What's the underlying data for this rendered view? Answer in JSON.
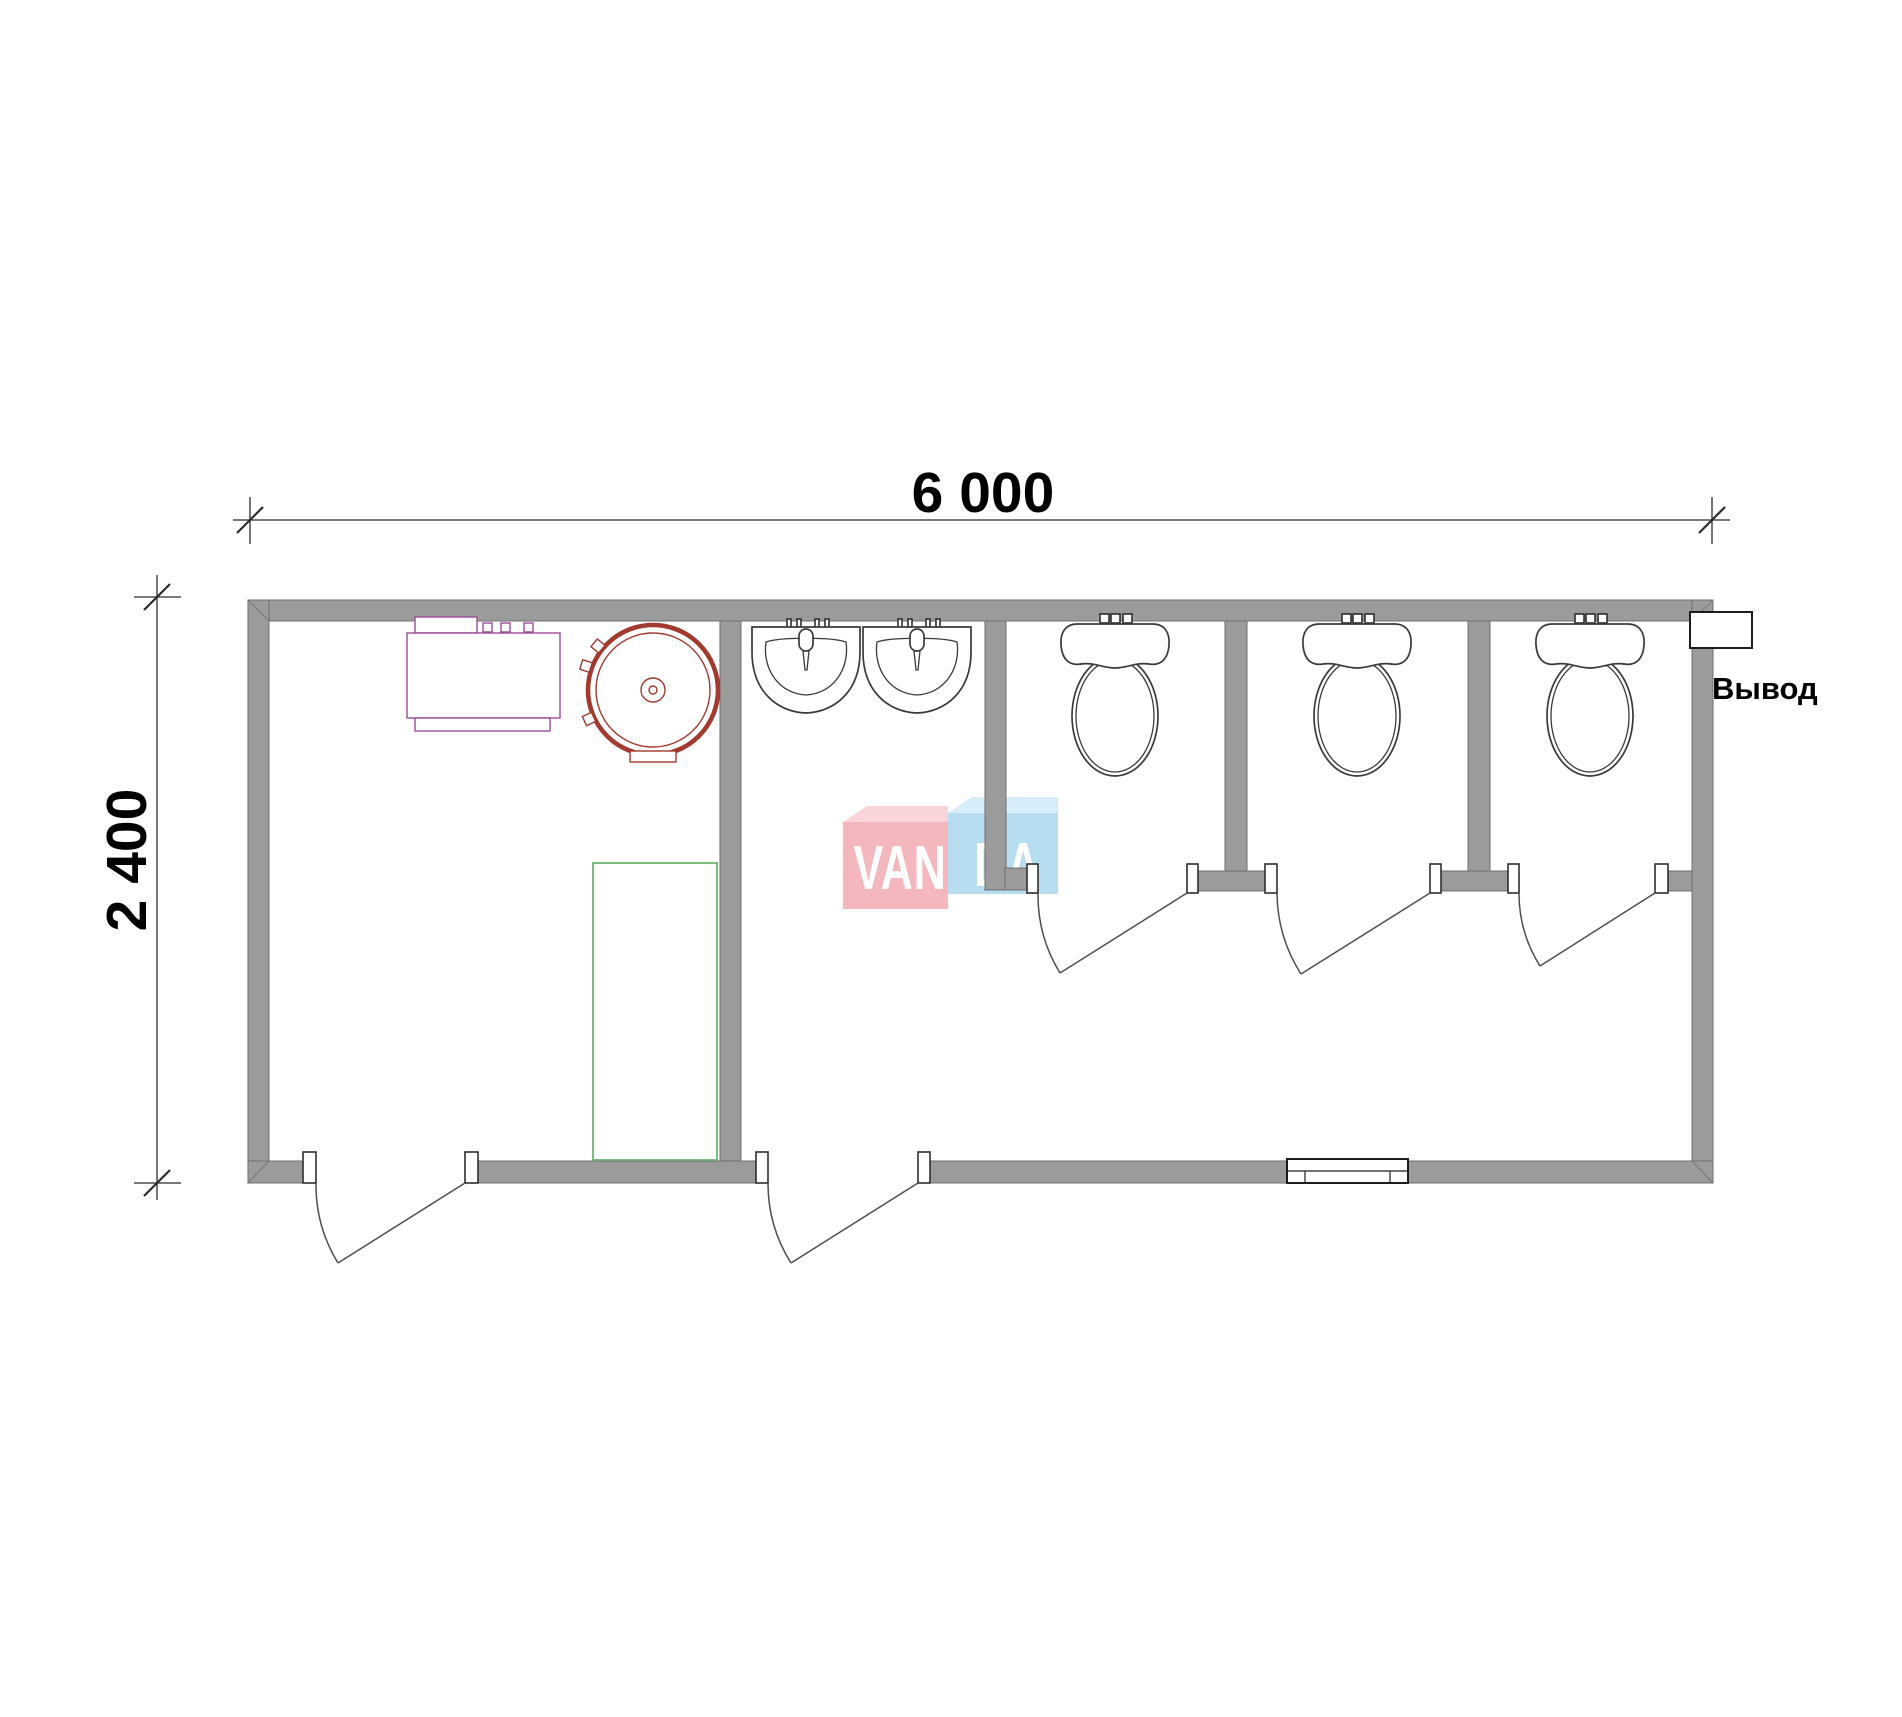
{
  "plan": {
    "dimension_width": {
      "label": "6 000"
    },
    "dimension_height": {
      "label": "2 400"
    },
    "outlet": {
      "label": "Вывод"
    },
    "watermark": {
      "text": "VANDA",
      "left": "VAN",
      "right": "DA"
    },
    "rooms": [
      "utility-room",
      "washroom",
      "wc-stall-1",
      "wc-stall-2",
      "wc-stall-3"
    ],
    "fixtures": [
      "water-heater",
      "storage-boiler",
      "shower-tray",
      "washbasin-1",
      "washbasin-2",
      "toilet-1",
      "toilet-2",
      "toilet-3",
      "window",
      "outlet-box"
    ],
    "door_count": 5,
    "colors": {
      "wall": "#9b9b9b",
      "wall_edge": "#6f6f6f",
      "line": "#3a3a3a",
      "door": "#4d4d4d",
      "dim": "#2b2b2b",
      "boiler": "#a13a2f",
      "appliance": "#994d99",
      "shower": "#63b269",
      "wm_pink": "#f3b7bd",
      "wm_pink_top": "#f9d4d8",
      "wm_blue": "#b7ddf0",
      "wm_blue_top": "#d7edf9"
    }
  }
}
